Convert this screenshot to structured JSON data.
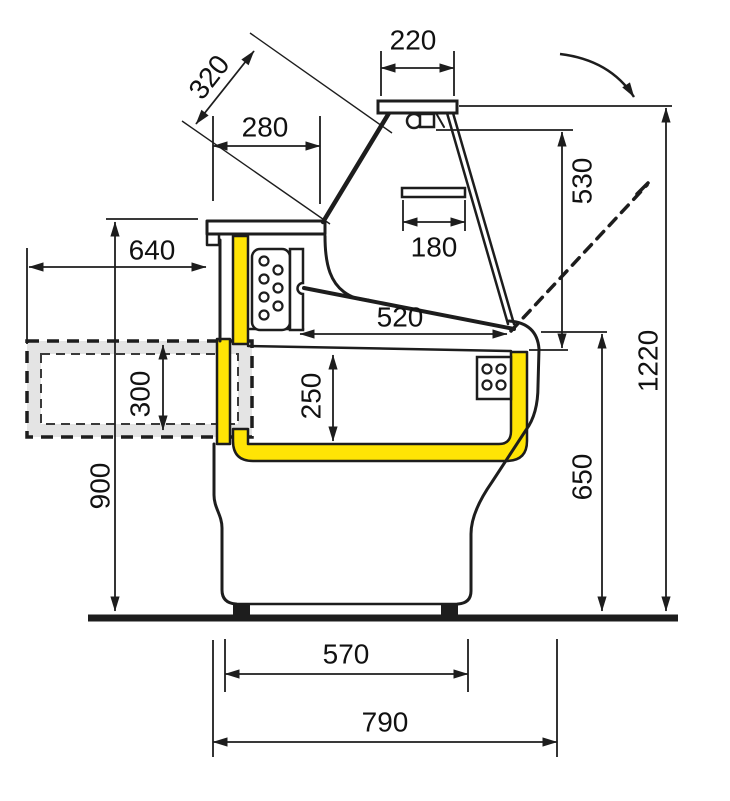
{
  "diagram": {
    "kind": "technical cross-section drawing with dimension lines",
    "dim_labels": {
      "d220": "220",
      "d320": "320",
      "d280": "280",
      "d180": "180",
      "d530": "530",
      "d1220": "1220",
      "d640": "640",
      "d900": "900",
      "d300": "300",
      "d250": "250",
      "d520": "520",
      "d650": "650",
      "d570": "570",
      "d790": "790"
    },
    "colors": {
      "line": "#1d1d1d",
      "insulation_yellow": "#ffe405",
      "board_gray": "#e4e4e4",
      "background": "#ffffff"
    }
  }
}
